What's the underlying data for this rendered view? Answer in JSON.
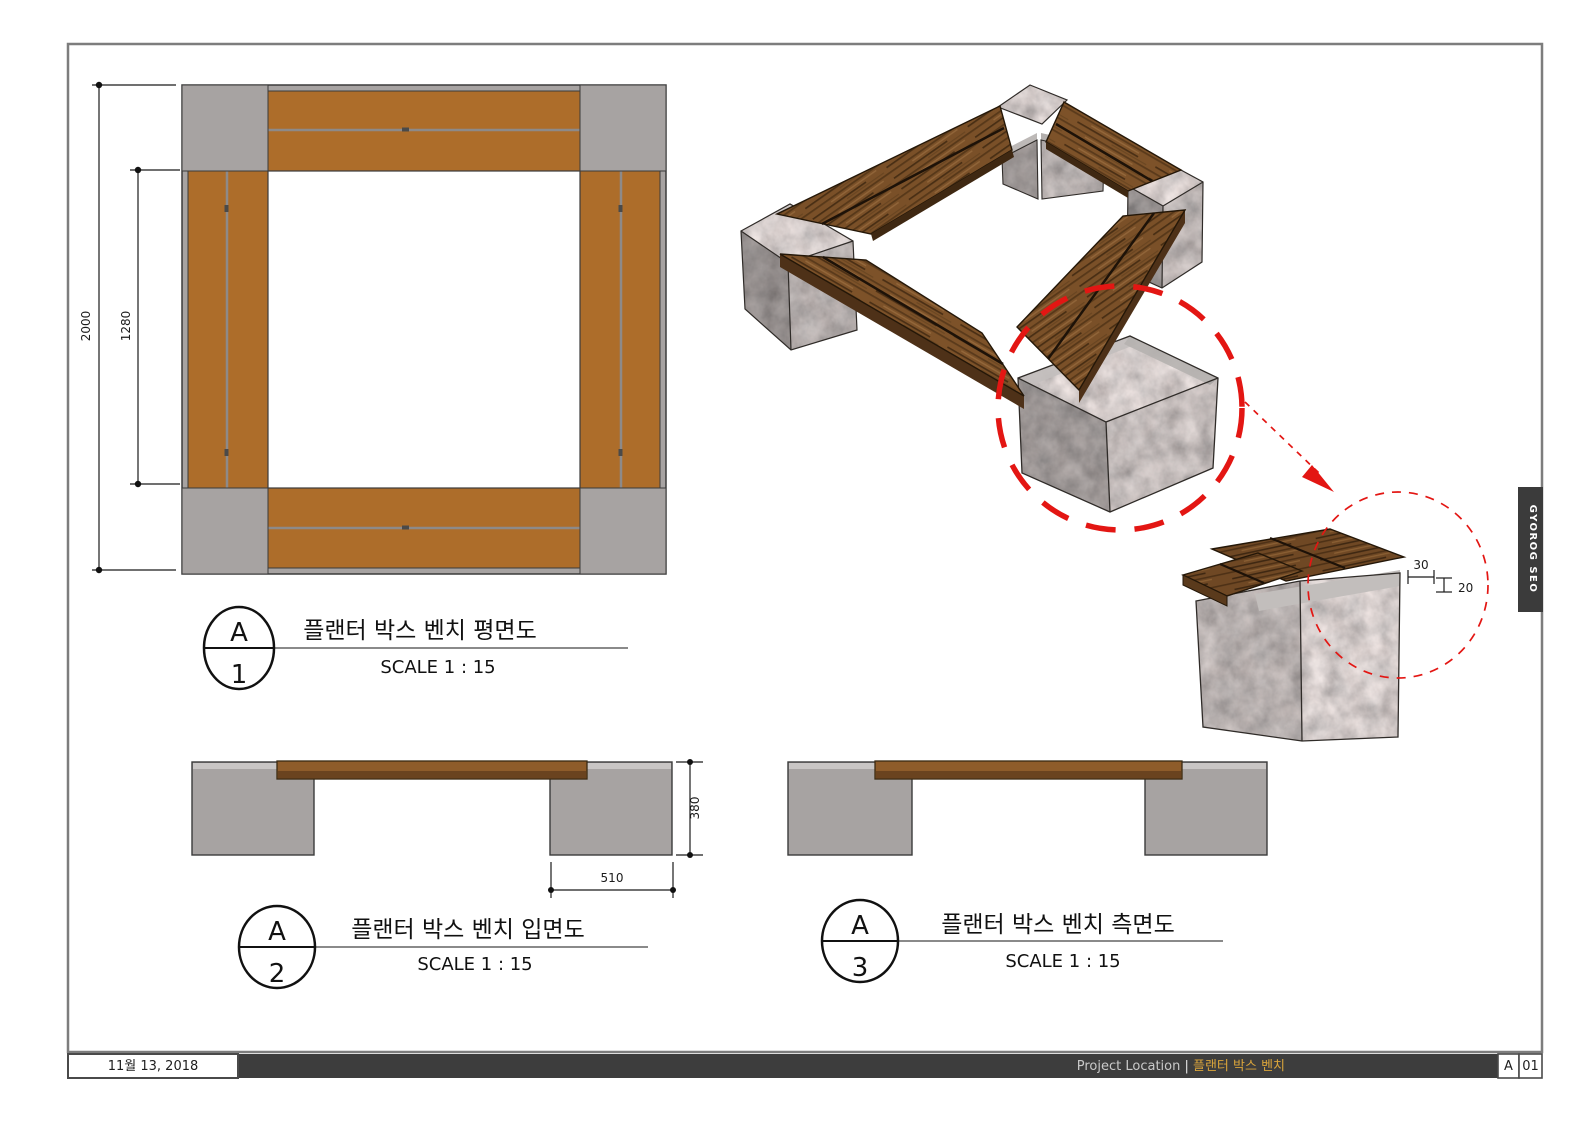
{
  "sheet": {
    "date": "11월 13, 2018",
    "footer_label": "Project Location",
    "footer_separator": " | ",
    "footer_project": "플랜터 박스 벤치",
    "revision": "A",
    "sheet_number": "01",
    "side_tab": "GYOROG SEO"
  },
  "views": {
    "plan": {
      "callout_letter": "A",
      "callout_number": "1",
      "title": "플랜터 박스 벤치 평면도",
      "scale": "SCALE 1 : 15",
      "dims": {
        "overall": "2000",
        "opening": "1280"
      }
    },
    "front": {
      "callout_letter": "A",
      "callout_number": "2",
      "title": "플랜터 박스 벤치 입면도",
      "scale": "SCALE 1 : 15",
      "dims": {
        "height": "380",
        "block_width": "510"
      }
    },
    "side": {
      "callout_letter": "A",
      "callout_number": "3",
      "title": "플랜터 박스 벤치 측면도",
      "scale": "SCALE 1 : 15"
    },
    "detail": {
      "dims": {
        "ledge_width": "30",
        "ledge_depth": "20"
      }
    }
  },
  "colors": {
    "wood_plan": "#ad6d2a",
    "wood_dark": "#6a431f",
    "stone_flat": "#a7a3a2",
    "stone_bevel": "#c9c6c5",
    "accent_red": "#e31613",
    "footer_bar": "#3d3d3d",
    "footer_accent": "#d9a43b"
  }
}
